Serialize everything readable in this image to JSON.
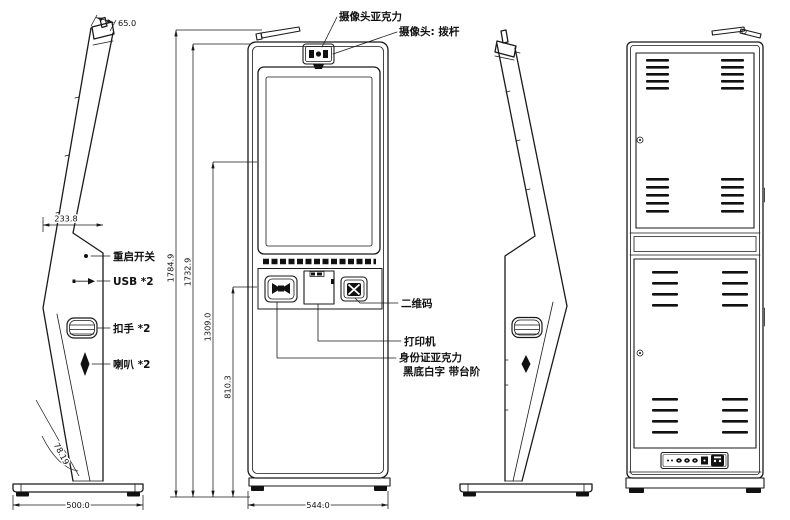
{
  "colors": {
    "background": "#ffffff",
    "ink": "#1a1a1a"
  },
  "callouts": {
    "camera_acrylic": "摄像头亚克力",
    "camera_lever": "摄像头: 拨杆",
    "restart_switch": "重启开关",
    "usb_x2": "USB *2",
    "handle_x2": "扣手 *2",
    "speaker_x2": "喇叭 *2",
    "qr_code": "二维码",
    "printer": "打印机",
    "id_card_acrylic": "身份证亚克力",
    "id_card_note": "黑底白字 带台阶"
  },
  "dimensions_mm": {
    "top_cap_depth": "65.0",
    "upper_body_depth": "233.8",
    "overall_height": "1784.9",
    "cabinet_height": "1732.9",
    "screen_center_height": "1309.0",
    "console_height": "810.3",
    "cabinet_width": "544.0",
    "base_depth": "500.0",
    "tilt_angle_deg": "78.19"
  }
}
